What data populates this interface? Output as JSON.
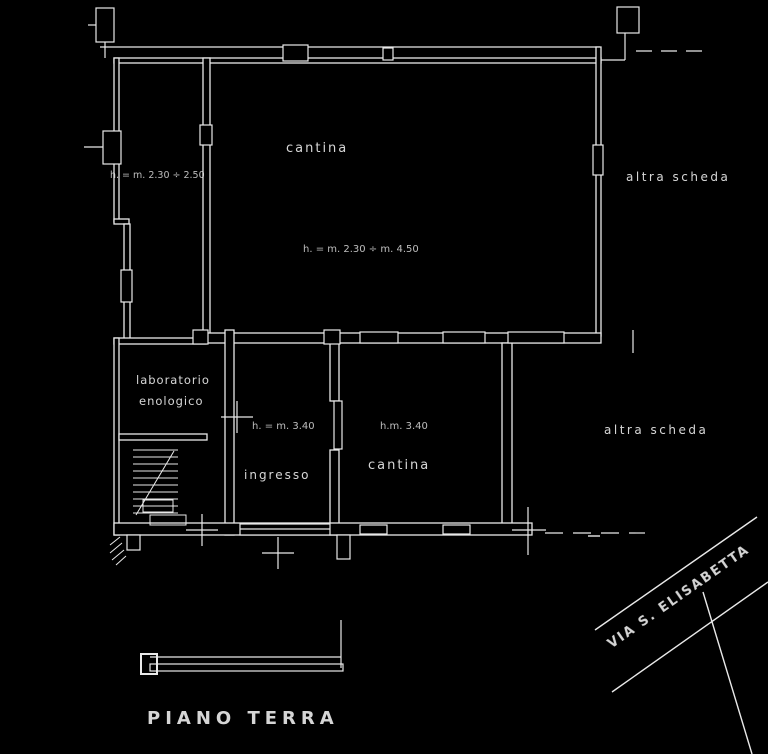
{
  "drawing": {
    "title": "PIANO TERRA",
    "background_color": "#000000",
    "line_color": "#e9e9e9"
  },
  "rooms": {
    "main_hall": {
      "label": "cantina",
      "height_note": "h. = m. 2.30 ÷ m. 4.50"
    },
    "top_left_room": {
      "height_note": "h. = m. 2.30 ÷ 2.50"
    },
    "laboratory": {
      "label_line1": "laboratorio",
      "label_line2": "enologico"
    },
    "entrance": {
      "label": "ingresso",
      "height_note": "h. = m. 3.40"
    },
    "cellar": {
      "label": "cantina",
      "height_note": "h.m. 3.40"
    }
  },
  "annotations": {
    "altra_scheda_top": "altra scheda",
    "altra_scheda_bottom": "altra scheda",
    "street_name": "VIA S. ELISABETTA"
  }
}
